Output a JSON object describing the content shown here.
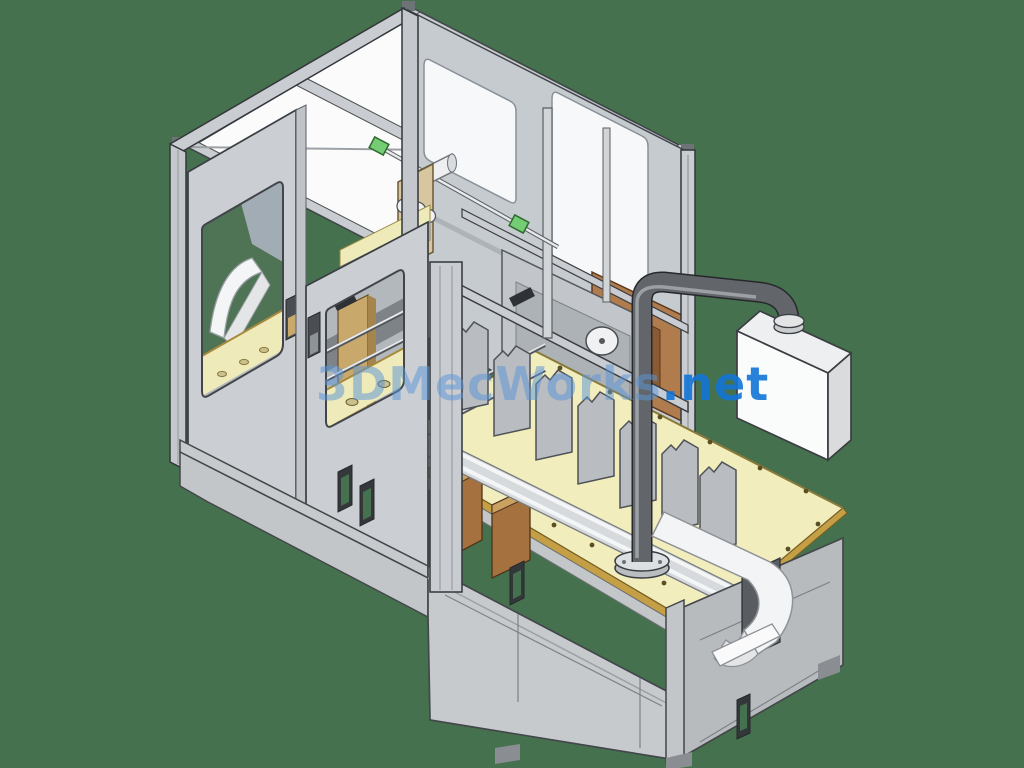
{
  "scene": {
    "title": "Isometric 3D CAD render of an enclosed automatic cartoning machine",
    "background_color": "#46714E",
    "parts": [
      "safety-enclosure-frame",
      "roof-panels",
      "end-face-sliding-doors",
      "door-windows",
      "door-handles",
      "machine-base-cabinet",
      "cabinet-handle-cutouts",
      "worktable-top",
      "carton-conveyor",
      "carton-divider-plates",
      "exhaust-pipe",
      "collection-box",
      "discharge-strap",
      "pulley-plate",
      "drive-rod-with-green-fittings",
      "back-wall-windows",
      "copper-side-panels"
    ]
  },
  "watermark": {
    "brand": "3DMecWorks",
    "suffix": ".net",
    "full_text": "3DMecWorks.net",
    "color_light": "rgba(90,150,214,0.52)",
    "color_dark": "rgba(18,116,214,0.90)"
  },
  "palette": {
    "background_green": "#46714E",
    "frame_gray": "#C9CDD1",
    "panel_gray": "#C6CACD",
    "shadow_gray": "#9CA1A5",
    "outline_dark": "#33373B",
    "table_yellow": "#F2EDBD",
    "trim_gold": "#C49F45",
    "wood_tan": "#D8C69E",
    "copper_brown": "#B07C4E",
    "pipe_gray": "#62666A",
    "fitting_green": "#74CC74",
    "box_white": "#FAFBFB",
    "roof_white": "#FBFBFC"
  }
}
